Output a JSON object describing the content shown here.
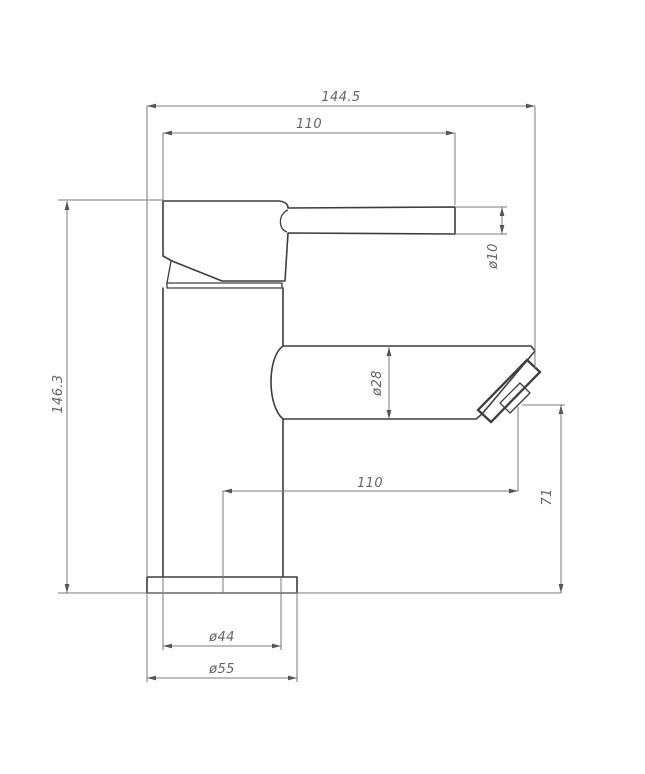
{
  "drawing": {
    "type": "technical-dimension-drawing",
    "subject": "single-lever basin mixer tap, side elevation",
    "background": "#ffffff",
    "line_colors": {
      "object": "#3d3d3d",
      "dimension": "#7a7a7a",
      "text": "#636363",
      "arrow": "#555555"
    }
  },
  "dimensions": {
    "overall_width": "144.5",
    "handle_length": "110",
    "handle_diameter": "ø10",
    "overall_height": "146.3",
    "spout_diameter": "ø28",
    "spout_reach": "110",
    "outlet_height": "71",
    "body_diameter": "ø44",
    "base_diameter": "ø55"
  }
}
